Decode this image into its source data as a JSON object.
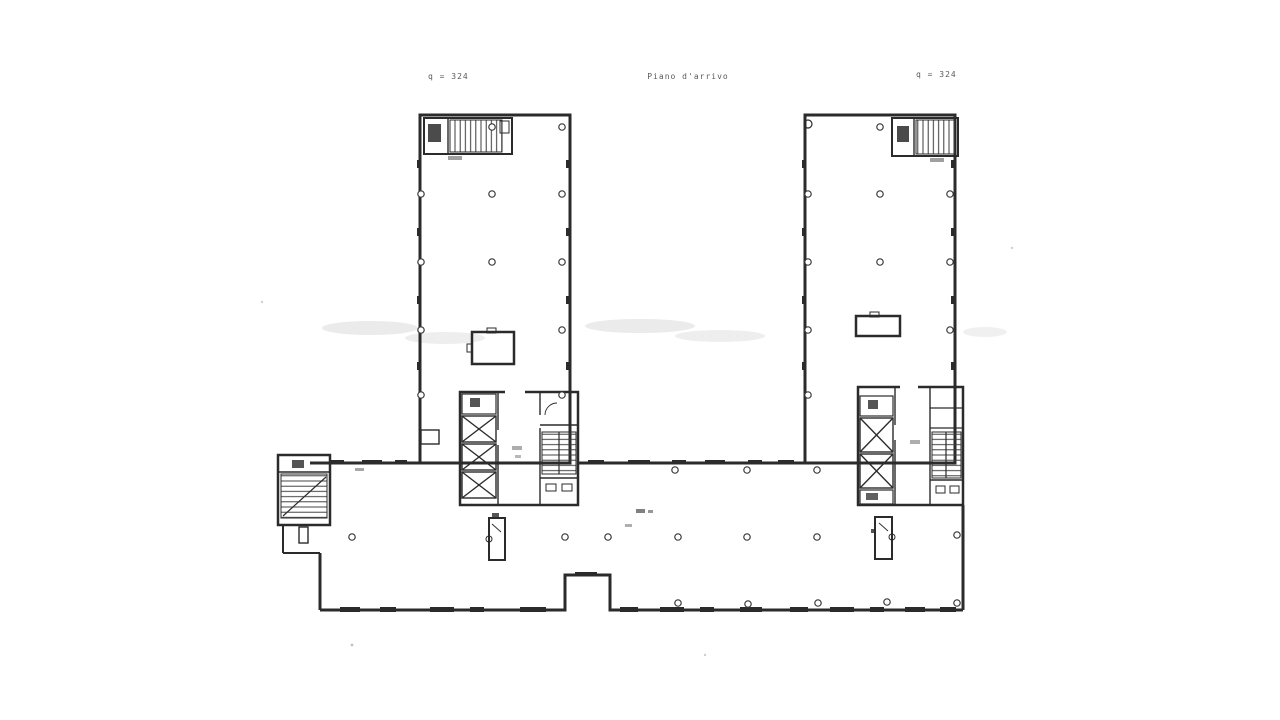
{
  "annotations": {
    "left_elevation_label": "q = 324",
    "center_title": "Piano d'arrivo",
    "right_elevation_label": "q = 324"
  },
  "colors": {
    "paper": "#ffffff",
    "ink": "#2b2b2b",
    "ink_light": "#555555",
    "smudge": "#d8d8d8"
  },
  "plan_symbols": {
    "elevator_shaft": "crossed-box",
    "staircase": "hatched-treads",
    "structural_column": "open-circle",
    "escalator": "narrow-box-with-pivot-circle",
    "roof_opening": "rectangle",
    "window_band": "dark-dash"
  }
}
